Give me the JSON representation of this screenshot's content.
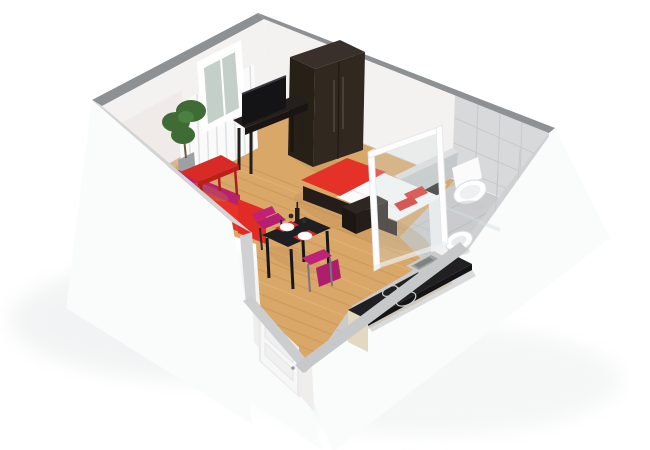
{
  "meta": {
    "kind": "3d-floorplan-render",
    "description": "Isometric 3D cutaway floor plan of a studio apartment, no visible text",
    "background": "#ffffff"
  },
  "rooms": [
    {
      "name": "living-bedroom",
      "floor": "light-wood"
    },
    {
      "name": "bathroom",
      "floor": "grey-tile"
    },
    {
      "name": "kitchen",
      "floor": "grey-tile"
    },
    {
      "name": "entry",
      "floor": "light-wood"
    }
  ],
  "furniture": [
    "wardrobe",
    "tv",
    "tv-stand",
    "radiator",
    "window",
    "plant",
    "bed",
    "bench",
    "sofa",
    "side-table",
    "dining-table",
    "dining-chairs",
    "kitchen-counter",
    "sink",
    "cooktop",
    "toilet",
    "bidet",
    "shower-enclosure",
    "entry-door",
    "partition-wall"
  ],
  "colors": {
    "page_bg": "#ffffff",
    "wall_top_far": "#8e9193",
    "wall_top_near": "#d2d4d5",
    "wall_inner": "#f4f2f1",
    "wall_outer": "#fafbfb",
    "tile_wall": "#d7d9db",
    "tile_floor": "#c9cbcd",
    "wood": "#d9a768",
    "sofa_red": "#e63229",
    "sofa_magenta": "#b9206f",
    "chair_magenta": "#c0227a",
    "table_red": "#d92b25",
    "wardrobe_brown": "#31281f",
    "furniture_dark": "#2e2622",
    "tv_black": "#141417",
    "counter_black": "#202023",
    "cabinet_cream": "#ece1cb",
    "fixture_white": "#ffffff",
    "glass": "#cfdadc",
    "door_white": "#f7f7f7",
    "plant_green": "#3f6b35",
    "bed_white": "#fbfbfb",
    "bed_red": "#e53228"
  }
}
